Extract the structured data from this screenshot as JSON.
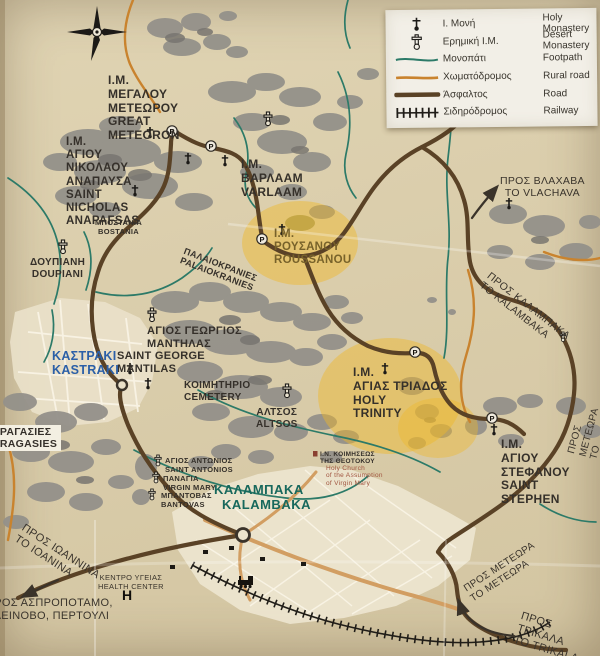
{
  "legend": {
    "items": [
      {
        "icon": "holy-monastery-icon",
        "gr": "Ι. Μονή",
        "en": "Holy Monastery"
      },
      {
        "icon": "desert-monastery-icon",
        "gr": "Ερημική Ι.Μ.",
        "en": "Desert Monastery"
      },
      {
        "icon": "footpath-line-icon",
        "gr": "Μονοπάτι",
        "en": "Footpath"
      },
      {
        "icon": "rural-road-line-icon",
        "gr": "Χωματόδρομος",
        "en": "Rural road"
      },
      {
        "icon": "road-line-icon",
        "gr": "Άσφαλτος",
        "en": "Road"
      },
      {
        "icon": "railway-line-icon",
        "gr": "Σιδηρόδρομος",
        "en": "Railway"
      }
    ]
  },
  "glyphs": {
    "parking": "P",
    "hospital": "H"
  },
  "colors": {
    "footpath": "#2c7a68",
    "rural_road": "#c9832e",
    "road": "#5a4226",
    "railway": "#201d18",
    "highlight": "#f0b929",
    "kastraki_text": "#2b5fa7",
    "kalambaka_text": "#17685c",
    "paper": "#d9cdab",
    "rock": "#94918a"
  },
  "labels": {
    "great_meteoron": {
      "gr": "Ι.Μ.\nΜΕΓΑΛΟΥ\nΜΕΤΕΩΡΟΥ",
      "en": "GREAT\nMETEORON"
    },
    "st_nicholas": {
      "gr": "Ι.Μ.\nΑΓΙΟΥ\nΝΙΚΟΛΑΟΥ\nΑΝΑΠΑΥΣΑ",
      "en": "SAINT\nNICHOLAS\nANAPAFSAS"
    },
    "varlaam": {
      "gr": "Ι.Μ.\nΒΑΡΛΑΑΜ",
      "en": "VARLAAM"
    },
    "roussanou": {
      "gr": "Ι.Μ.\nΡΟΥΣΑΝΟΥ",
      "en": "ROUSSANOU"
    },
    "to_vlachava": {
      "gr": "ΠΡΟΣ ΒΛΑΧΑΒΑ",
      "en": "TO VLACHAVA"
    },
    "bostania": {
      "gr": "ΜΠΟΣΤΑΝΙΑ",
      "en": "BOSTANIA"
    },
    "doupiani": {
      "gr": "ΔΟΥΠΙΑΝΗ",
      "en": "DOUPIANI"
    },
    "palaiokranies": {
      "gr": "ΠΑΛΑΙΟΚΡΑΝΙΕΣ",
      "en": "PALAIOKRANIES"
    },
    "st_george": {
      "gr": "ΑΓΙΟΣ ΓΕΩΡΓΙΟΣ\nΜΑΝΤΗΛΑΣ",
      "en": "SAINT GEORGE\nMANTILAS"
    },
    "kastraki": {
      "gr": "ΚΑΣΤΡΑΚΙ",
      "en": "KASTRAKI"
    },
    "cemetery": {
      "gr": "ΚΟΙΜΗΤΗΡΙΟ",
      "en": "CEMETERY"
    },
    "altsos": {
      "gr": "ΑΛΤΣΟΣ",
      "en": "ALTSOS"
    },
    "holy_trinity": {
      "gr": "Ι.Μ.\nΑΓΙΑΣ ΤΡΙΑΔΟΣ",
      "en": "HOLY\nTRINITY"
    },
    "to_kalambaka_road": {
      "gr": "ΠΡΟΣ ΚΑΛΑΜΠΑΚΑ",
      "en": "ΤΟ KALAMBAKA"
    },
    "to_meteora_east": {
      "gr": "ΠΡΟΣ ΜΕΤΕΩΡΑ",
      "en": "ΤΟ ΜΕΤΕΩΡΑ"
    },
    "st_stephen": {
      "gr": "Ι.Μ.\nΑΓΙΟΥ\nΣΤΕΦΑΝΟΥ",
      "en": "SAINT\nSTEPHEN"
    },
    "dragasies": {
      "gr": "ΔΡΑΓΑΣΙΕΣ",
      "en": "DRAGASIES"
    },
    "st_antonios": {
      "gr": "ΑΓΙΟΣ ΑΝΤΩΝΙΟΣ",
      "en": "SAINT ANTONIOS"
    },
    "panagia": {
      "gr": "ΠΑΝΑΓΙΑ",
      "en": "VIRGIN MARY"
    },
    "bantovas": {
      "gr": "ΜΠΑΝΤΟΒΑΣ",
      "en": "BANTOVAS"
    },
    "kalambaka": {
      "gr": "ΚΑΛΑΜΠΑΚΑ",
      "en": "KALAMBAKA"
    },
    "assumption_church": {
      "gr": "Ι.Ν. ΚΟΙΜΗΣΕΩΣ\nΤΗΣ ΘΕΟΤΟΚΟΥ",
      "en": "Holy Church\nof the Assumption\nof Virgin Mary"
    },
    "to_ioannina": {
      "gr": "ΠΡΟΣ ΙΩΑΝΝΙΝΑ",
      "en": "ΤΟ ΙΟΑΝΙΝΑ"
    },
    "health_center": {
      "gr": "ΚΕΝΤΡΟ ΥΓΕΙΑΣ",
      "en": "HEALTH CENTER"
    },
    "to_aspropotamo": {
      "gr": "ΠΡΟΣ ΑΣΠΡΟΠΟΤΑΜΟ,\nΚΛΕΙΝΟΒΟ, ΠΕΡΤΟΥΛΙ"
    },
    "to_meteora_south": {
      "gr": "ΠΡΟΣ ΜΕΤΕΩΡΑ",
      "en": "ΤΟ ΜΕΤΕΩΡΑ"
    },
    "to_trikala": {
      "gr": "ΠΡΟΣ ΤΡΙΚΑΛΑ",
      "en": "ΤΟ TRIKALA"
    }
  }
}
